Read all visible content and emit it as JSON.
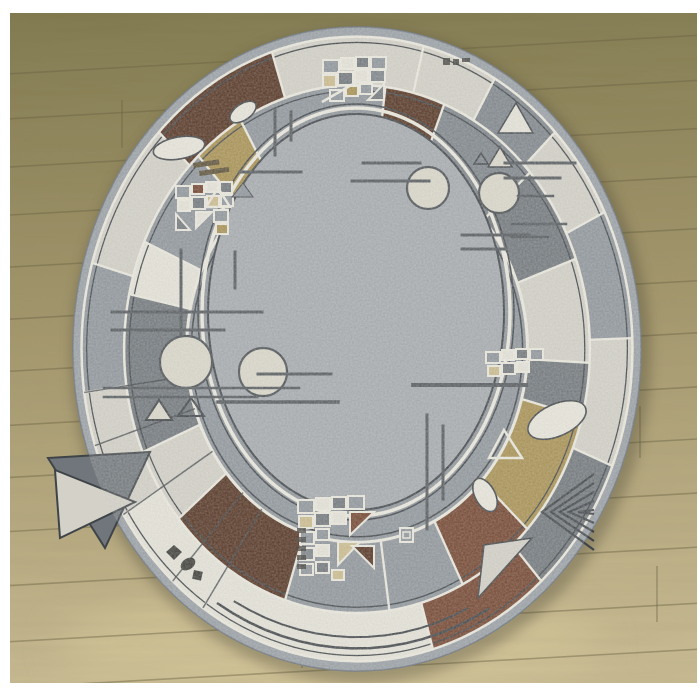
{
  "scene": {
    "subject": "oval patchwork-border rug lying on wooden laminate floor",
    "photo_frame": {
      "x": 10,
      "y": 13,
      "w": 687,
      "h": 670,
      "background": "#ffffff"
    }
  },
  "palette": {
    "binding": "#99a0a6",
    "bindingEdge": "#79818a",
    "speckleLight": "#d4d2c8",
    "speckleWhite": "#e7e5da",
    "grayMid": "#8e959b",
    "graySlate": "#7d848a",
    "grayDark": "#70767b",
    "brownRust": "#72422c",
    "brownDark": "#52311f",
    "tanGold": "#a8904f",
    "tanLight": "#cdbd8d",
    "field": "#a6abaf",
    "transition": "#8f969c",
    "lineDark": "#3f4448",
    "lineWhite": "#edebe0",
    "motifLight": "#dcd9cb",
    "ink": "#3a3a35",
    "hatch": "#5b4f35",
    "shadow": "#4a4530"
  },
  "floor": {
    "top": "#7f784d",
    "mid": "#a2956a",
    "bottom": "#c9bb92",
    "plank": "#6b6444",
    "tilt_deg": -3.2,
    "plank_ys": [
      55,
      100,
      148,
      196,
      248,
      300,
      352,
      406,
      458,
      512,
      566,
      622,
      668
    ],
    "seams": [
      [
        122,
        100,
        148
      ],
      [
        424,
        55,
        100
      ],
      [
        560,
        148,
        196
      ],
      [
        82,
        300,
        352
      ],
      [
        640,
        406,
        458
      ],
      [
        302,
        622,
        668
      ],
      [
        186,
        512,
        566
      ],
      [
        520,
        248,
        300
      ],
      [
        657,
        566,
        622
      ]
    ],
    "highlight": {
      "cx": 330,
      "cy": 645,
      "rx": 270,
      "ry": 55,
      "color": "#dbcc9e"
    }
  },
  "rug": {
    "cx": 357,
    "cy": 349,
    "rx": 284,
    "ry": 322,
    "field": {
      "cx": 356,
      "cy": 312,
      "rx": 148,
      "ry": 198
    },
    "ringA": {
      "outer": 0.97,
      "inner": 0.82,
      "blocks": [
        [
          342,
          374,
          "speckleLight"
        ],
        [
          14,
          30,
          "speckleLight"
        ],
        [
          30,
          46,
          "graySlate"
        ],
        [
          46,
          64,
          "speckleLight"
        ],
        [
          64,
          88,
          "grayMid"
        ],
        [
          88,
          112,
          "speckleLight"
        ],
        [
          112,
          138,
          "grayDark"
        ],
        [
          138,
          164,
          "brownRust"
        ],
        [
          164,
          214,
          "speckleWhite"
        ],
        [
          214,
          238,
          "speckleWhite"
        ],
        [
          238,
          262,
          "speckleLight"
        ],
        [
          262,
          286,
          "grayMid"
        ],
        [
          286,
          314,
          "speckleLight"
        ],
        [
          314,
          342,
          "brownDark"
        ]
      ]
    },
    "ringB": {
      "outer": 0.82,
      "inner": 0.6,
      "blocks": [
        [
          330,
          374,
          "grayMid"
        ],
        [
          7,
          22,
          "brownDark"
        ],
        [
          22,
          48,
          "graySlate"
        ],
        [
          48,
          70,
          "grayDark"
        ],
        [
          70,
          93,
          "speckleLight"
        ],
        [
          93,
          105,
          "grayDark"
        ],
        [
          105,
          133,
          "tanGold"
        ],
        [
          133,
          153,
          "brownRust"
        ],
        [
          153,
          172,
          "grayMid"
        ],
        [
          172,
          198,
          "grayMid"
        ],
        [
          198,
          230,
          "brownDark"
        ],
        [
          230,
          247,
          "speckleLight"
        ],
        [
          247,
          282,
          "grayDark"
        ],
        [
          282,
          294,
          "speckleWhite"
        ],
        [
          294,
          317,
          "grayMid"
        ],
        [
          317,
          330,
          "tanGold"
        ]
      ]
    },
    "concentric": [
      {
        "f": 0.97,
        "color": "lineWhite",
        "w": 2.5
      },
      {
        "f": 0.952,
        "color": "lineDark",
        "w": 1.3
      },
      {
        "f": 0.82,
        "color": "lineWhite",
        "w": 2.5
      },
      {
        "f": 0.802,
        "color": "lineDark",
        "w": 1.3
      },
      {
        "f": 0.6,
        "color": "lineWhite",
        "w": 3
      },
      {
        "f": 0.583,
        "color": "lineDark",
        "w": 1.5
      }
    ],
    "bottom_arcs": [
      {
        "f": 0.93,
        "a0": 150,
        "a1": 212,
        "w": 2.5
      },
      {
        "f": 0.895,
        "a0": 154,
        "a1": 209,
        "w": 2
      }
    ],
    "dark_radials": [
      214,
      222,
      238,
      252,
      262
    ],
    "field_edge": [
      {
        "off": 0,
        "color": "lineDark",
        "w": 2
      },
      {
        "off": 6,
        "color": "lineWhite",
        "w": 3.5
      },
      {
        "off": 10,
        "color": "lineDark",
        "w": 1.5
      }
    ],
    "accent_lines": [
      [
        275,
        110,
        275,
        155,
        3
      ],
      [
        291,
        112,
        291,
        140,
        3
      ],
      [
        240,
        172,
        301,
        172,
        3
      ],
      [
        363,
        163,
        420,
        163,
        3
      ],
      [
        352,
        181,
        429,
        181,
        3
      ],
      [
        462,
        235,
        529,
        235,
        3
      ],
      [
        462,
        249,
        506,
        249,
        3
      ],
      [
        235,
        252,
        235,
        288,
        3
      ],
      [
        181,
        250,
        181,
        334,
        3
      ],
      [
        112,
        312,
        262,
        312,
        3
      ],
      [
        112,
        330,
        224,
        330,
        3
      ],
      [
        104,
        388,
        299,
        388,
        2.5
      ],
      [
        104,
        397,
        257,
        397,
        2.5
      ],
      [
        218,
        402,
        338,
        402,
        3.5
      ],
      [
        258,
        374,
        331,
        374,
        3
      ],
      [
        413,
        385,
        526,
        385,
        4
      ],
      [
        427,
        415,
        427,
        529,
        3
      ],
      [
        443,
        426,
        443,
        499,
        3
      ],
      [
        505,
        163,
        575,
        163,
        3
      ],
      [
        505,
        178,
        560,
        178,
        3
      ],
      [
        518,
        196,
        553,
        196,
        2.5
      ],
      [
        512,
        224,
        566,
        224,
        2.5
      ],
      [
        512,
        237,
        548,
        237,
        2.5
      ]
    ],
    "circles": [
      [
        428,
        188,
        21
      ],
      [
        263,
        372,
        24
      ],
      [
        186,
        362,
        26
      ],
      [
        499,
        193,
        20
      ]
    ],
    "beans": [
      [
        243,
        112,
        15,
        8,
        -35
      ],
      [
        179,
        148,
        26,
        11,
        -10
      ],
      [
        557,
        420,
        31,
        16,
        -24
      ],
      [
        485,
        495,
        18,
        10,
        62
      ]
    ],
    "triangles": [
      {
        "p": [
          [
            498,
            133
          ],
          [
            516,
            103
          ],
          [
            533,
            133
          ]
        ],
        "f": "speckleWhite",
        "s": "lineDark",
        "w": 1.5
      },
      {
        "p": [
          [
            488,
            167
          ],
          [
            500,
            147
          ],
          [
            512,
            167
          ]
        ],
        "f": "motifLight",
        "s": "lineDark",
        "w": 1.5
      },
      {
        "p": [
          [
            474,
            164
          ],
          [
            481,
            153
          ],
          [
            488,
            164
          ]
        ],
        "f": "none",
        "s": "lineDark",
        "w": 1.5
      },
      {
        "p": [
          [
            206,
            207
          ],
          [
            218,
            188
          ],
          [
            230,
            207
          ]
        ],
        "f": "none",
        "s": "lineWhite",
        "w": 2.5
      },
      {
        "p": [
          [
            232,
            197
          ],
          [
            243,
            183
          ],
          [
            253,
            197
          ]
        ],
        "f": "grayMid",
        "s": "lineDark",
        "w": 1
      },
      {
        "p": [
          [
            146,
            420
          ],
          [
            159,
            400
          ],
          [
            172,
            420
          ]
        ],
        "f": "motifLight",
        "s": "lineDark",
        "w": 2
      },
      {
        "p": [
          [
            178,
            416
          ],
          [
            191,
            398
          ],
          [
            204,
            416
          ]
        ],
        "f": "none",
        "s": "lineDark",
        "w": 2
      },
      {
        "p": [
          [
            504,
            430
          ],
          [
            522,
            458
          ],
          [
            489,
            458
          ]
        ],
        "f": "none",
        "s": "lineWhite",
        "w": 2.5
      },
      {
        "p": [
          [
            48,
            458
          ],
          [
            150,
            452
          ],
          [
            105,
            548
          ]
        ],
        "f": "grayDark",
        "s": "lineDark",
        "w": 2
      },
      {
        "p": [
          [
            55,
            470
          ],
          [
            135,
            502
          ],
          [
            60,
            538
          ]
        ],
        "f": "speckleLight",
        "s": "lineDark",
        "w": 2
      },
      {
        "p": [
          [
            484,
            545
          ],
          [
            532,
            538
          ],
          [
            478,
            598
          ]
        ],
        "f": "speckleLight",
        "s": "lineDark",
        "w": 1.5
      }
    ],
    "chevron": {
      "cx": 594,
      "step": 9,
      "count": 5,
      "top": 474,
      "mid_x": 542,
      "mid_y": 512,
      "bot": 550,
      "w": 2.2
    },
    "diamonds": [
      {
        "type": "poly",
        "p": [
          [
            174,
            545
          ],
          [
            182,
            552
          ],
          [
            174,
            560
          ],
          [
            166,
            552
          ]
        ]
      },
      {
        "type": "ellipse",
        "cx": 188,
        "cy": 564,
        "rx": 8,
        "ry": 5.5,
        "rot": -35
      },
      {
        "type": "rect",
        "x": 194,
        "y": 570,
        "w": 9,
        "h": 9,
        "rot": 12
      }
    ],
    "glyphs": [
      [
        443,
        58,
        7,
        7
      ],
      [
        453,
        59,
        6,
        6
      ],
      [
        462,
        58,
        8,
        4
      ]
    ],
    "stubs": [
      [
        297,
        528
      ],
      [
        297,
        537
      ],
      [
        297,
        546
      ],
      [
        297,
        555
      ],
      [
        297,
        564
      ]
    ],
    "hatches": [
      [
        193,
        163,
        26,
        5
      ],
      [
        199,
        171,
        30,
        5
      ]
    ],
    "square_motif": {
      "x": 400,
      "y": 528,
      "w": 13,
      "h": 14
    },
    "tile_clusters": [
      {
        "name": "top",
        "rects": [
          [
            323,
            60,
            16,
            13,
            "grayMid"
          ],
          [
            341,
            58,
            13,
            11,
            "speckleWhite"
          ],
          [
            356,
            57,
            13,
            11,
            "grayDark"
          ],
          [
            371,
            57,
            15,
            12,
            "grayMid"
          ],
          [
            323,
            75,
            13,
            12,
            "tanLight"
          ],
          [
            338,
            72,
            15,
            13,
            "grayDark"
          ],
          [
            355,
            70,
            13,
            12,
            "speckleWhite"
          ],
          [
            370,
            70,
            15,
            12,
            "graySlate"
          ],
          [
            330,
            90,
            14,
            11,
            "grayMid"
          ],
          [
            346,
            86,
            12,
            10,
            "tanGold"
          ],
          [
            360,
            84,
            12,
            10,
            "grayMid"
          ]
        ],
        "tris": [
          [
            [
              368,
              100
            ],
            [
              384,
              84
            ],
            [
              384,
              100
            ],
            "grayDark"
          ]
        ],
        "lines": [
          [
            322,
            102,
            360,
            80
          ]
        ]
      },
      {
        "name": "left",
        "rects": [
          [
            176,
            186,
            14,
            12,
            "grayMid"
          ],
          [
            192,
            184,
            12,
            10,
            "brownRust"
          ],
          [
            206,
            182,
            12,
            10,
            "speckleWhite"
          ],
          [
            220,
            182,
            12,
            11,
            "grayDark"
          ],
          [
            178,
            200,
            12,
            11,
            "speckleWhite"
          ],
          [
            192,
            197,
            13,
            12,
            "grayDark"
          ],
          [
            207,
            196,
            12,
            11,
            "tanLight"
          ],
          [
            221,
            195,
            12,
            11,
            "grayMid"
          ],
          [
            214,
            210,
            14,
            12,
            "grayMid"
          ],
          [
            216,
            224,
            12,
            10,
            "tanGold"
          ]
        ],
        "tris": [
          [
            [
              176,
              214
            ],
            [
              190,
              230
            ],
            [
              176,
              230
            ],
            "grayDark"
          ],
          [
            [
              196,
              212
            ],
            [
              212,
              212
            ],
            [
              196,
              228
            ],
            "speckleWhite"
          ]
        ],
        "lines": []
      },
      {
        "name": "bottom",
        "rects": [
          [
            298,
            500,
            16,
            13,
            "grayMid"
          ],
          [
            316,
            498,
            14,
            12,
            "speckleWhite"
          ],
          [
            332,
            497,
            14,
            12,
            "grayDark"
          ],
          [
            348,
            496,
            16,
            13,
            "grayMid"
          ],
          [
            299,
            516,
            14,
            12,
            "tanLight"
          ],
          [
            315,
            513,
            15,
            13,
            "grayDark"
          ],
          [
            332,
            512,
            14,
            12,
            "speckleWhite"
          ],
          [
            300,
            532,
            14,
            12,
            "grayMid"
          ],
          [
            316,
            529,
            13,
            11,
            "grayMid"
          ],
          [
            300,
            548,
            14,
            12,
            "graySlate"
          ],
          [
            316,
            545,
            13,
            11,
            "speckleWhite"
          ],
          [
            300,
            564,
            13,
            11,
            "grayMid"
          ],
          [
            316,
            562,
            13,
            11,
            "grayDark"
          ],
          [
            332,
            570,
            12,
            10,
            "tanLight"
          ]
        ],
        "tris": [
          [
            [
              350,
              512
            ],
            [
              374,
              512
            ],
            [
              350,
              535
            ],
            "brownRust"
          ],
          [
            [
              338,
              542
            ],
            [
              360,
              542
            ],
            [
              338,
              565
            ],
            "tanLight"
          ],
          [
            [
              352,
              546
            ],
            [
              374,
              546
            ],
            [
              374,
              568
            ],
            "brownDark"
          ]
        ],
        "lines": []
      },
      {
        "name": "right",
        "rects": [
          [
            486,
            352,
            14,
            11,
            "grayMid"
          ],
          [
            502,
            350,
            12,
            10,
            "speckleWhite"
          ],
          [
            516,
            349,
            12,
            10,
            "grayDark"
          ],
          [
            530,
            349,
            13,
            11,
            "grayMid"
          ],
          [
            488,
            366,
            12,
            10,
            "tanLight"
          ],
          [
            502,
            363,
            13,
            11,
            "grayDark"
          ],
          [
            517,
            362,
            12,
            10,
            "speckleWhite"
          ]
        ],
        "tris": [],
        "lines": []
      }
    ]
  }
}
